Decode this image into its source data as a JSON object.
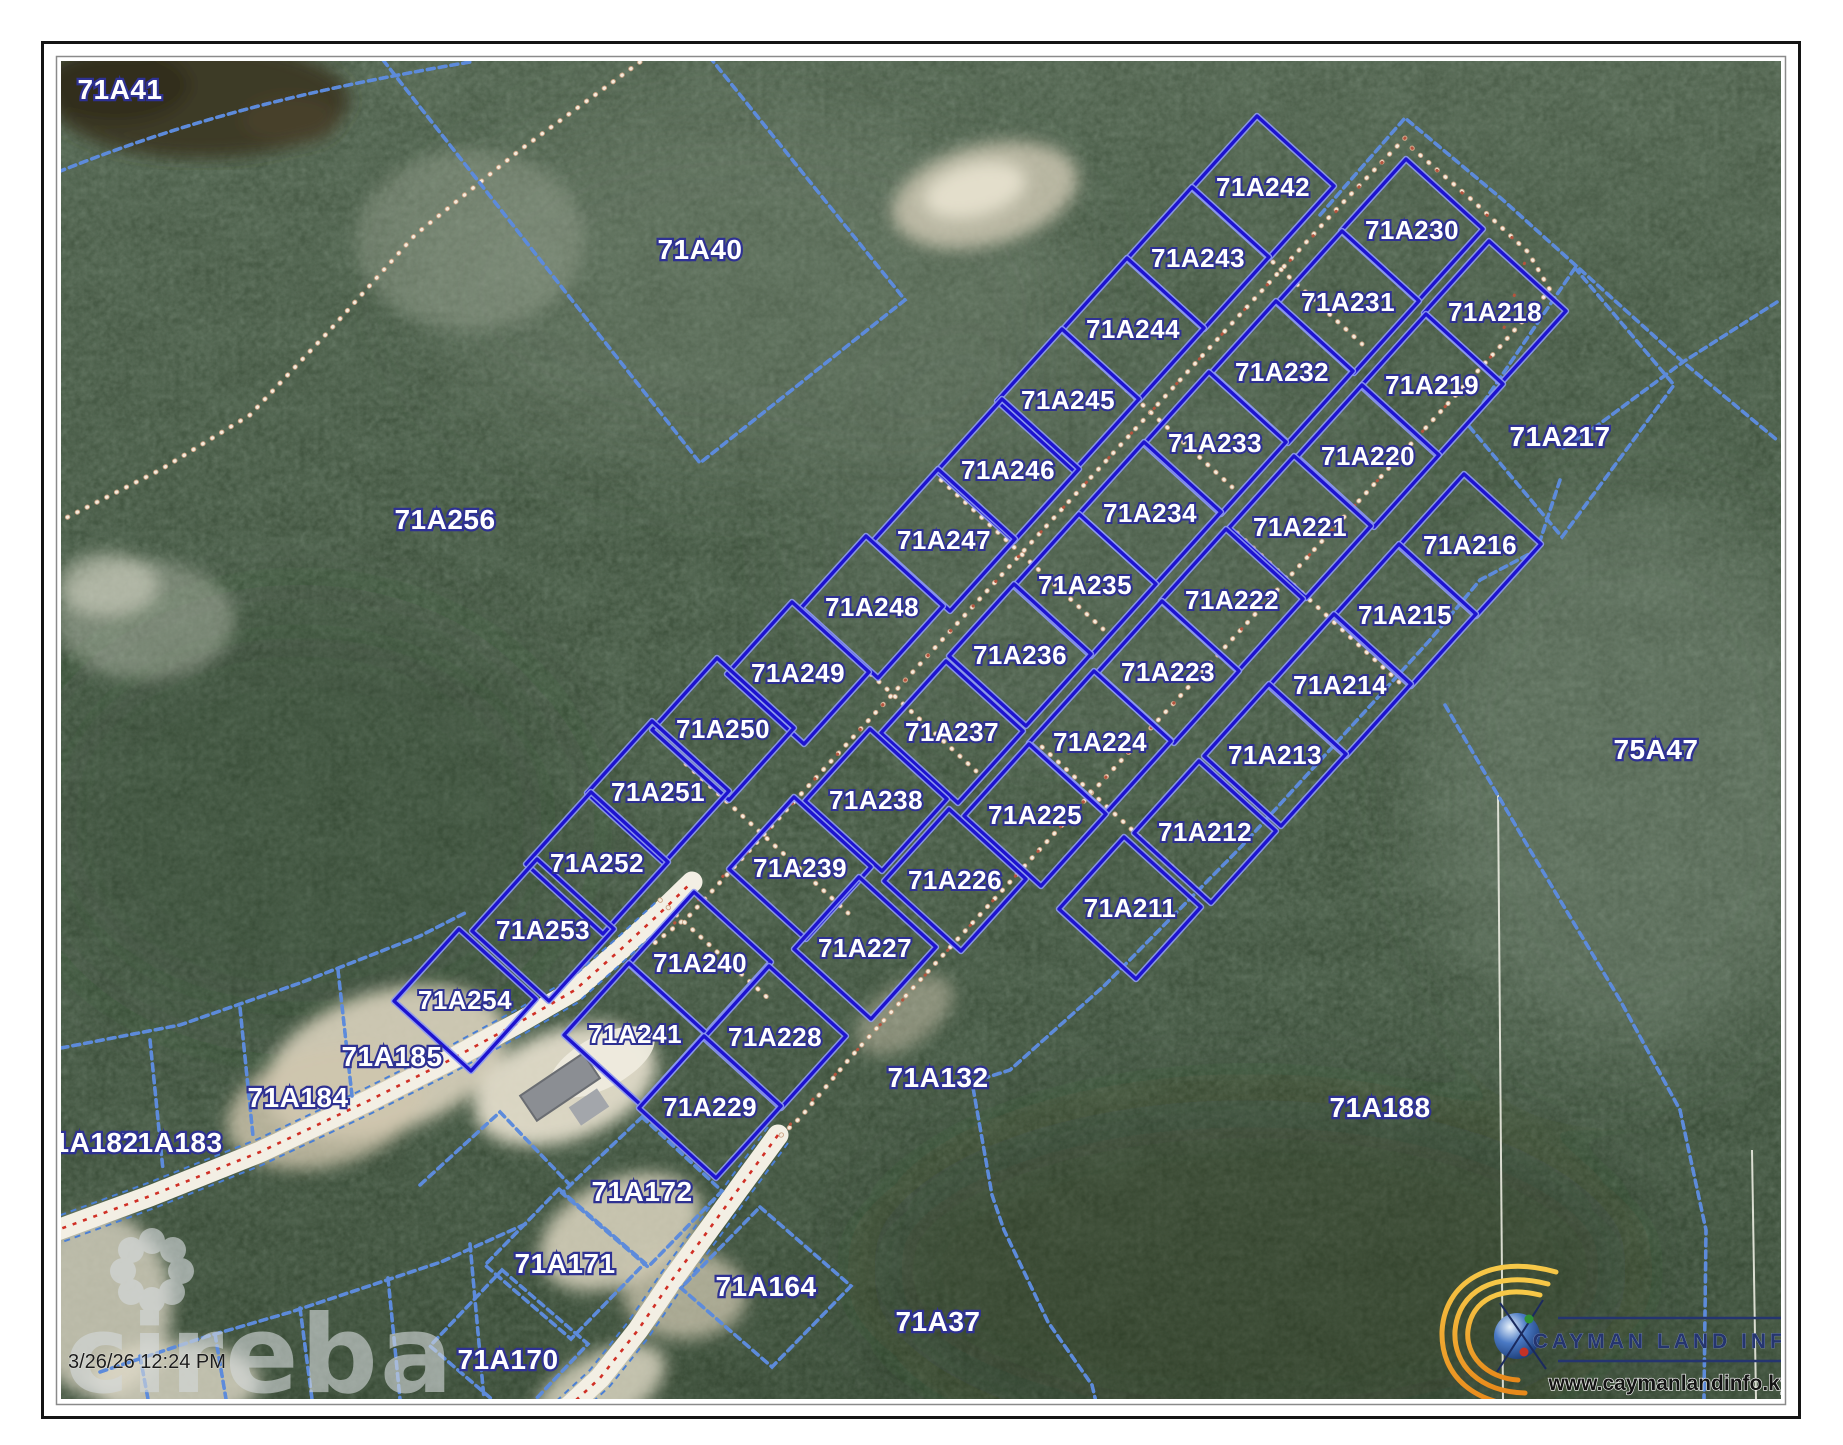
{
  "watermark": {
    "brand": "cireba"
  },
  "timestamp": "3/26/26 12:24 PM",
  "branding": {
    "name": "CAYMAN LAND INFO",
    "website": "www.caymanlandinfo.ky"
  },
  "parcels": {
    "subdivision": [
      "71A242",
      "71A243",
      "71A244",
      "71A245",
      "71A246",
      "71A247",
      "71A248",
      "71A249",
      "71A250",
      "71A251",
      "71A252",
      "71A253",
      "71A254",
      "71A230",
      "71A231",
      "71A232",
      "71A233",
      "71A234",
      "71A235",
      "71A236",
      "71A237",
      "71A238",
      "71A239",
      "71A218",
      "71A219",
      "71A220",
      "71A221",
      "71A222",
      "71A223",
      "71A224",
      "71A225",
      "71A226",
      "71A227",
      "71A216",
      "71A215",
      "71A214",
      "71A213",
      "71A212",
      "71A211",
      "71A240",
      "71A241",
      "71A228",
      "71A229"
    ],
    "context": [
      "71A41",
      "71A40",
      "71A256",
      "75A47",
      "71A217",
      "71A132",
      "71A188",
      "71A37",
      "71A185",
      "71A184",
      "71A183",
      "71A182",
      "71A172",
      "71A171",
      "71A170",
      "71A164"
    ]
  },
  "colors": {
    "subdivision_line": "#1d13cf",
    "context_line": "#5d8bdb",
    "label_fill": "#ffffff",
    "label_outline": "#2e3192",
    "road_fill": "#f3efe4",
    "road_centerline": "#d03026",
    "logo_gold": "#f2a71b",
    "logo_navy": "#25356f"
  }
}
